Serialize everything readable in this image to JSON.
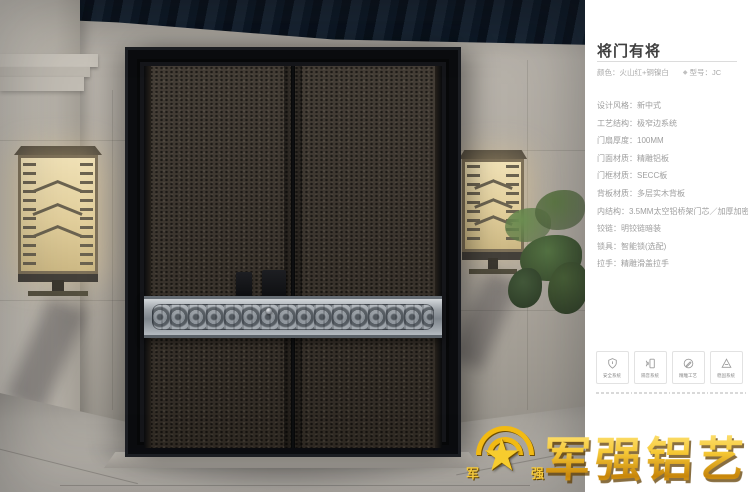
{
  "panel": {
    "title": "将门有将",
    "color_line": "颜色：火山红+铜镍白",
    "model_icon": "◆",
    "model_line": "型号：JC",
    "specs": [
      "设计风格：新中式",
      "工艺结构：极窄边系统",
      "门扇厚度：100MM",
      "门面材质：精雕铝板",
      "门框材质：SECC板",
      "背板材质：多层实木背板",
      "内结构：3.5MM太空铝桥架门芯／加厚加密航空铝板",
      "铰链：明铰链暗装",
      "锁具：智能锁(选配)",
      "拉手：精雕滑盖拉手"
    ],
    "badges": [
      {
        "icon": "shield-icon",
        "label": "安全系统"
      },
      {
        "icon": "soundproof-icon",
        "label": "隔音系统"
      },
      {
        "icon": "engrave-icon",
        "label": "精雕工艺"
      },
      {
        "icon": "stability-icon",
        "label": "稳固系统"
      }
    ]
  },
  "logo": {
    "text": "军强铝艺",
    "emblem_left": "军",
    "emblem_right": "强"
  },
  "colors": {
    "gold_accent": "#f2ba13",
    "panel_text": "#9e9e9e",
    "door_leaf": "#3a332b",
    "band_silver": "#9aa0a6"
  }
}
